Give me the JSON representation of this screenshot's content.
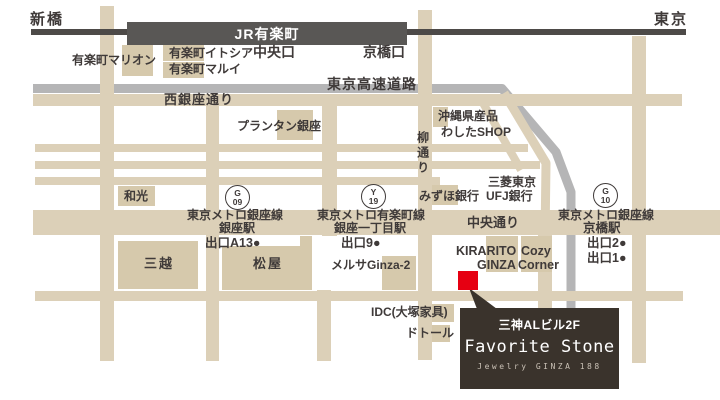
{
  "colors": {
    "road_beige": "#DCD0B8",
    "building_beige": "#D6C9AC",
    "expressway_gray": "#B5B5B6",
    "jr_dark_gray": "#4D4A48",
    "jr_bar_gray": "#595755",
    "label_text": "#3F3A39",
    "marker_red": "#E60012",
    "info_box_bg": "#3A332C",
    "info_box_subtitle": "#C9C0B5"
  },
  "jr_bar": {
    "label": "JR有楽町"
  },
  "info_box": {
    "building": "三神ALビル2F",
    "shop_name": "Favorite Stone",
    "subtitle": "Jewelry GINZA 188"
  },
  "badges": [
    {
      "id": "badge-ginza-station-g09",
      "letter": "G",
      "number": "09",
      "x": 237,
      "y": 197
    },
    {
      "id": "badge-ginza-itchome-station-y19",
      "letter": "Y",
      "number": "19",
      "x": 373,
      "y": 196
    },
    {
      "id": "badge-kyobashi-station-g10",
      "letter": "G",
      "number": "10",
      "x": 605,
      "y": 195
    }
  ],
  "labels": [
    {
      "id": "shinbashi-label",
      "text": "新橋",
      "x": 30,
      "y": 12,
      "fs": 15,
      "ls": 2
    },
    {
      "id": "tokyo-label",
      "text": "東京",
      "x": 654,
      "y": 12,
      "fs": 15,
      "ls": 2
    },
    {
      "id": "jr-chuo-exit-label",
      "text": "中央口",
      "x": 253,
      "y": 45,
      "fs": 14
    },
    {
      "id": "jr-kyobashi-exit-label",
      "text": "京橋口",
      "x": 363,
      "y": 45,
      "fs": 14
    },
    {
      "id": "yurakucho-marion-label",
      "text": "有楽町マリオン",
      "x": 72,
      "y": 54,
      "fs": 12
    },
    {
      "id": "yurakucho-itocia-label",
      "text": "有楽町イトシア",
      "x": 169,
      "y": 47,
      "fs": 12
    },
    {
      "id": "yurakucho-marui-label",
      "text": "有楽町マルイ",
      "x": 169,
      "y": 63,
      "fs": 12
    },
    {
      "id": "tokyo-expressway-label",
      "text": "東京高速道路",
      "x": 327,
      "y": 77,
      "fs": 14,
      "ls": 1
    },
    {
      "id": "nishi-ginza-dori-label",
      "text": "西銀座通り",
      "x": 164,
      "y": 93,
      "fs": 13,
      "ls": 1
    },
    {
      "id": "printemps-ginza-label",
      "text": "プランタン銀座",
      "x": 237,
      "y": 120,
      "fs": 12
    },
    {
      "id": "okinawa-shop-label-line1",
      "text": "沖縄県産品",
      "x": 438,
      "y": 110,
      "fs": 12
    },
    {
      "id": "okinawa-shop-label-line2",
      "text": "わしたSHOP",
      "x": 441,
      "y": 126,
      "fs": 12
    },
    {
      "id": "yanagi-dori-label",
      "text": "柳通り",
      "x": 416,
      "y": 131,
      "fs": 12,
      "vertical": true
    },
    {
      "id": "wako-label",
      "text": "和光",
      "x": 124,
      "y": 190,
      "fs": 12
    },
    {
      "id": "mizuho-bank-label",
      "text": "みずほ銀行",
      "x": 419,
      "y": 190,
      "fs": 12
    },
    {
      "id": "mufg-bank-label-line1",
      "text": "三菱東京",
      "x": 488,
      "y": 176,
      "fs": 12
    },
    {
      "id": "mufg-bank-label-line2",
      "text": "UFJ銀行",
      "x": 486,
      "y": 190,
      "fs": 12
    },
    {
      "id": "ginza-station-line-label",
      "text": "東京メトロ銀座線",
      "x": 187,
      "y": 209,
      "fs": 12
    },
    {
      "id": "ginza-station-name-label",
      "text": "銀座駅",
      "x": 219,
      "y": 222,
      "fs": 12
    },
    {
      "id": "ginza-station-exit-label",
      "text": "出口A13●",
      "x": 205,
      "y": 237,
      "fs": 12.5
    },
    {
      "id": "ginza-itchome-line-label",
      "text": "東京メトロ有楽町線",
      "x": 317,
      "y": 209,
      "fs": 12
    },
    {
      "id": "ginza-itchome-name-label",
      "text": "銀座一丁目駅",
      "x": 334,
      "y": 222,
      "fs": 12
    },
    {
      "id": "ginza-itchome-exit-label",
      "text": "出口9●",
      "x": 341,
      "y": 237,
      "fs": 12.5
    },
    {
      "id": "kyobashi-station-line-label",
      "text": "東京メトロ銀座線",
      "x": 558,
      "y": 209,
      "fs": 12
    },
    {
      "id": "kyobashi-station-name-label",
      "text": "京橋駅",
      "x": 583,
      "y": 222,
      "fs": 12.5
    },
    {
      "id": "kyobashi-station-exit2-label",
      "text": "出口2●",
      "x": 587,
      "y": 237,
      "fs": 12.5
    },
    {
      "id": "kyobashi-station-exit1-label",
      "text": "出口1●",
      "x": 587,
      "y": 252,
      "fs": 12.5
    },
    {
      "id": "chuo-dori-label",
      "text": "中央通り",
      "x": 467,
      "y": 216,
      "fs": 13
    },
    {
      "id": "mitsukoshi-label",
      "text": "三越",
      "x": 144,
      "y": 257,
      "fs": 13,
      "ls": 2
    },
    {
      "id": "matsuya-label",
      "text": "松屋",
      "x": 253,
      "y": 257,
      "fs": 13,
      "ls": 2
    },
    {
      "id": "melsa-ginza2-label",
      "text": "メルサGinza-2",
      "x": 331,
      "y": 259,
      "fs": 12
    },
    {
      "id": "kirarito-label-line1",
      "text": "KIRARITO",
      "x": 456,
      "y": 245,
      "fs": 12.5
    },
    {
      "id": "kirarito-label-line2",
      "text": "GINZA",
      "x": 477,
      "y": 259,
      "fs": 12.5
    },
    {
      "id": "cozy-corner-label-line1",
      "text": "Cozy",
      "x": 521,
      "y": 245,
      "fs": 12.5
    },
    {
      "id": "cozy-corner-label-line2",
      "text": "Corner",
      "x": 518,
      "y": 259,
      "fs": 12.5
    },
    {
      "id": "idc-otsuka-label",
      "text": "IDC(大塚家具)",
      "x": 371,
      "y": 306,
      "fs": 12
    },
    {
      "id": "doutor-label",
      "text": "ドトール",
      "x": 406,
      "y": 327,
      "fs": 12
    }
  ]
}
